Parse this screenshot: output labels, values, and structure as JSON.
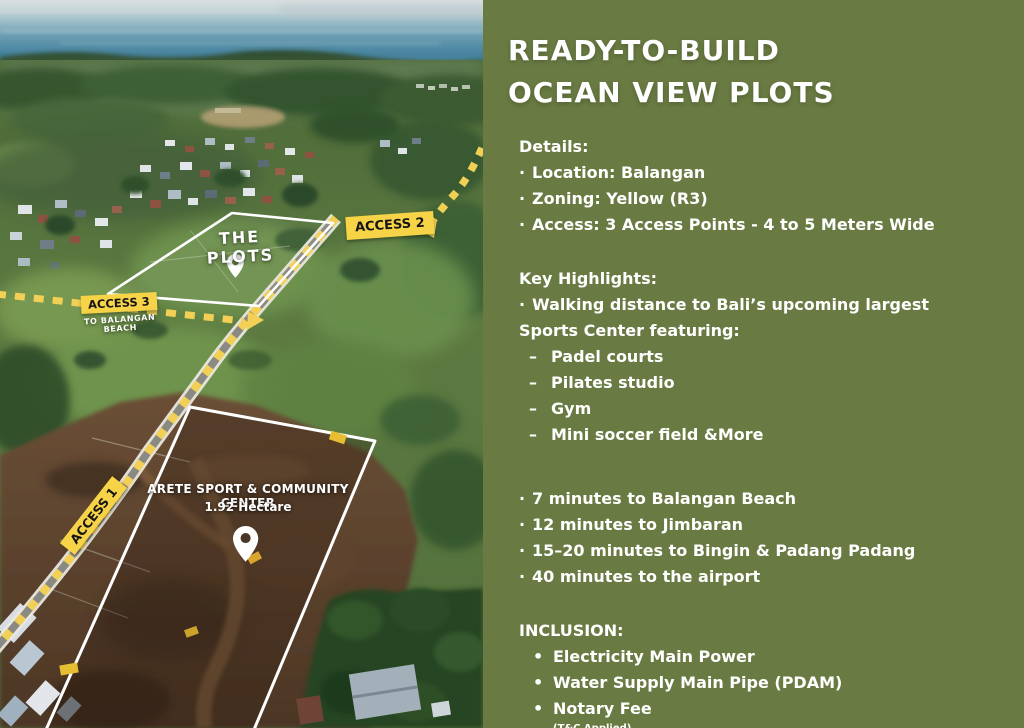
{
  "chars": {
    "middot": "·",
    "endash": "–",
    "bullet": "•"
  },
  "colors": {
    "panel_green": "#697b42",
    "badge_yellow": "#f7d348",
    "road_dash_yellow": "#f2cf55",
    "outline_white": "#ffffff"
  },
  "map": {
    "plots_label": "THE PLOTS",
    "access1_label": "ACCESS 1",
    "access2_label": "ACCESS 2",
    "access3_label": "ACCESS 3",
    "access3_sub": "TO BALANGAN BEACH",
    "arete_title": "ARETE SPORT & COMMUNITY CENTER",
    "arete_area": "1.92 Hectare"
  },
  "panel": {
    "title_line1": "READY-TO-BUILD",
    "title_line2": "OCEAN VIEW PLOTS",
    "details": {
      "heading": "Details:",
      "items": [
        "Location: Balangan",
        "Zoning: Yellow (R3)",
        "Access: 3 Access Points - 4 to 5 Meters Wide"
      ]
    },
    "key_highlights": {
      "heading": "Key Highlights:",
      "intro_line1": "Walking distance to Bali’s upcoming largest",
      "intro_line2": "Sports Center featuring:",
      "sub_items": [
        "Padel courts",
        "Pilates studio",
        "Gym",
        "Mini soccer field &More"
      ]
    },
    "distances": [
      "7 minutes to Balangan Beach",
      "12 minutes to Jimbaran",
      "15–20 minutes to Bingin & Padang Padang",
      "40 minutes to the airport"
    ],
    "inclusion": {
      "heading": "INCLUSION:",
      "items": [
        "Electricity Main Power",
        "Water Supply Main Pipe (PDAM)",
        "Notary Fee"
      ],
      "note": "(T&C Applied)"
    }
  }
}
